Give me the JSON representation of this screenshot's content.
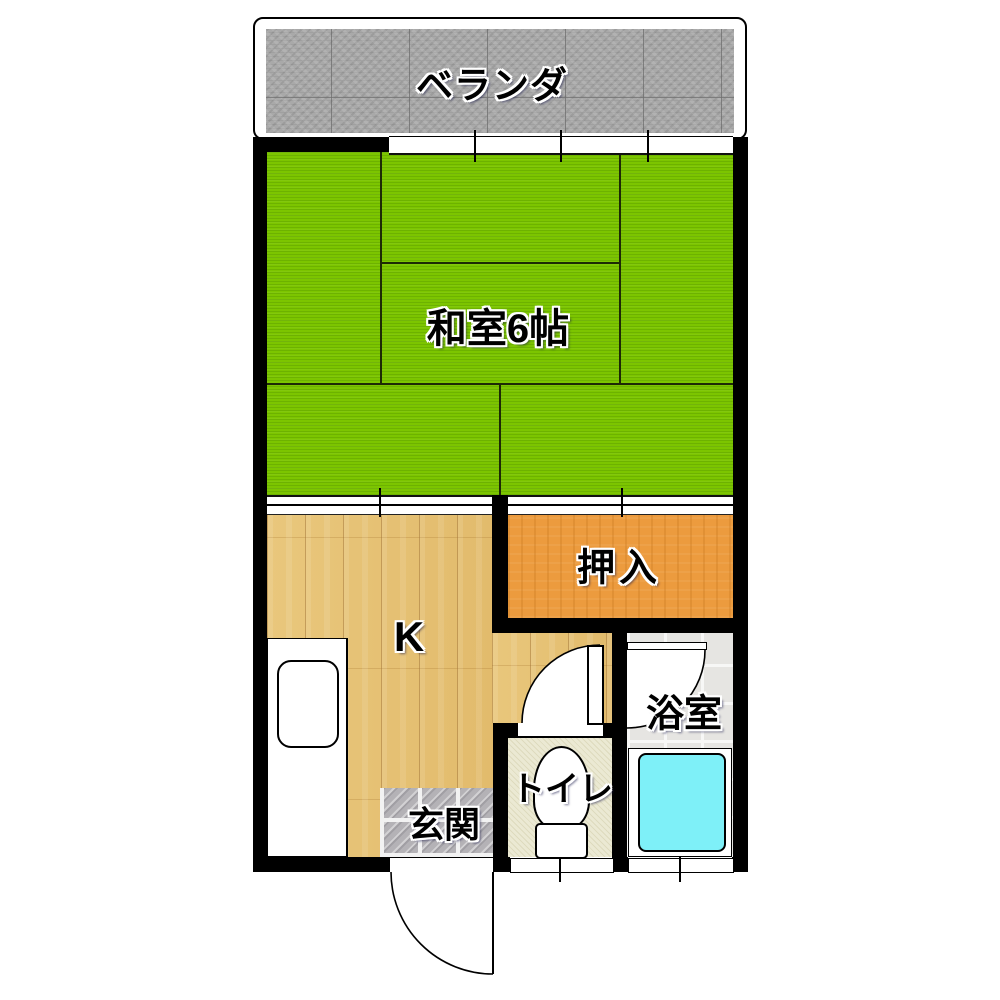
{
  "floorplan": {
    "type": "japanese-apartment-1K-floor-plan",
    "rooms": {
      "veranda": {
        "label": "ベランダ",
        "floor": "concrete"
      },
      "washitsu": {
        "label": "和室6帖",
        "floor": "tatami",
        "size_tatami_mats": 6
      },
      "oshiire": {
        "label": "押入",
        "floor": "closet"
      },
      "kitchen": {
        "label": "K",
        "floor": "wood"
      },
      "genkan": {
        "label": "玄関",
        "floor": "stone-tile"
      },
      "toilet": {
        "label": "トイレ",
        "floor": "cream-vinyl"
      },
      "bathroom": {
        "label": "浴室",
        "floor": "white-tile"
      }
    },
    "fixtures": [
      "kitchen-counter-with-sink",
      "toilet-bowl-and-tank",
      "bathtub"
    ],
    "doors": [
      {
        "name": "entrance-door",
        "type": "swing",
        "location": "bottom-wall"
      },
      {
        "name": "toilet-door",
        "type": "swing",
        "location": "toilet-top-wall"
      },
      {
        "name": "bathroom-door",
        "type": "swing",
        "location": "bathroom-top-wall"
      },
      {
        "name": "washitsu-kitchen-sliding-door",
        "type": "sliding"
      },
      {
        "name": "washitsu-oshiire-sliding-door",
        "type": "sliding"
      }
    ],
    "windows": [
      {
        "name": "veranda-window",
        "location": "top-wall",
        "panels": 3
      },
      {
        "name": "toilet-window",
        "location": "bottom-wall"
      },
      {
        "name": "bathroom-window",
        "location": "bottom-wall"
      }
    ],
    "colors": {
      "wall": "#000000",
      "tatami_green": "#7cc500",
      "closet_orange": "#ec9b3e",
      "wood_floor": "#e6c176",
      "veranda_concrete": "#a9a9a9",
      "genkan_tile_gray": "#b4b2b6",
      "toilet_floor_cream": "#ebe9d3",
      "bath_tile": "#e6e5e2",
      "bathtub_cyan": "#7ef0f8"
    }
  }
}
